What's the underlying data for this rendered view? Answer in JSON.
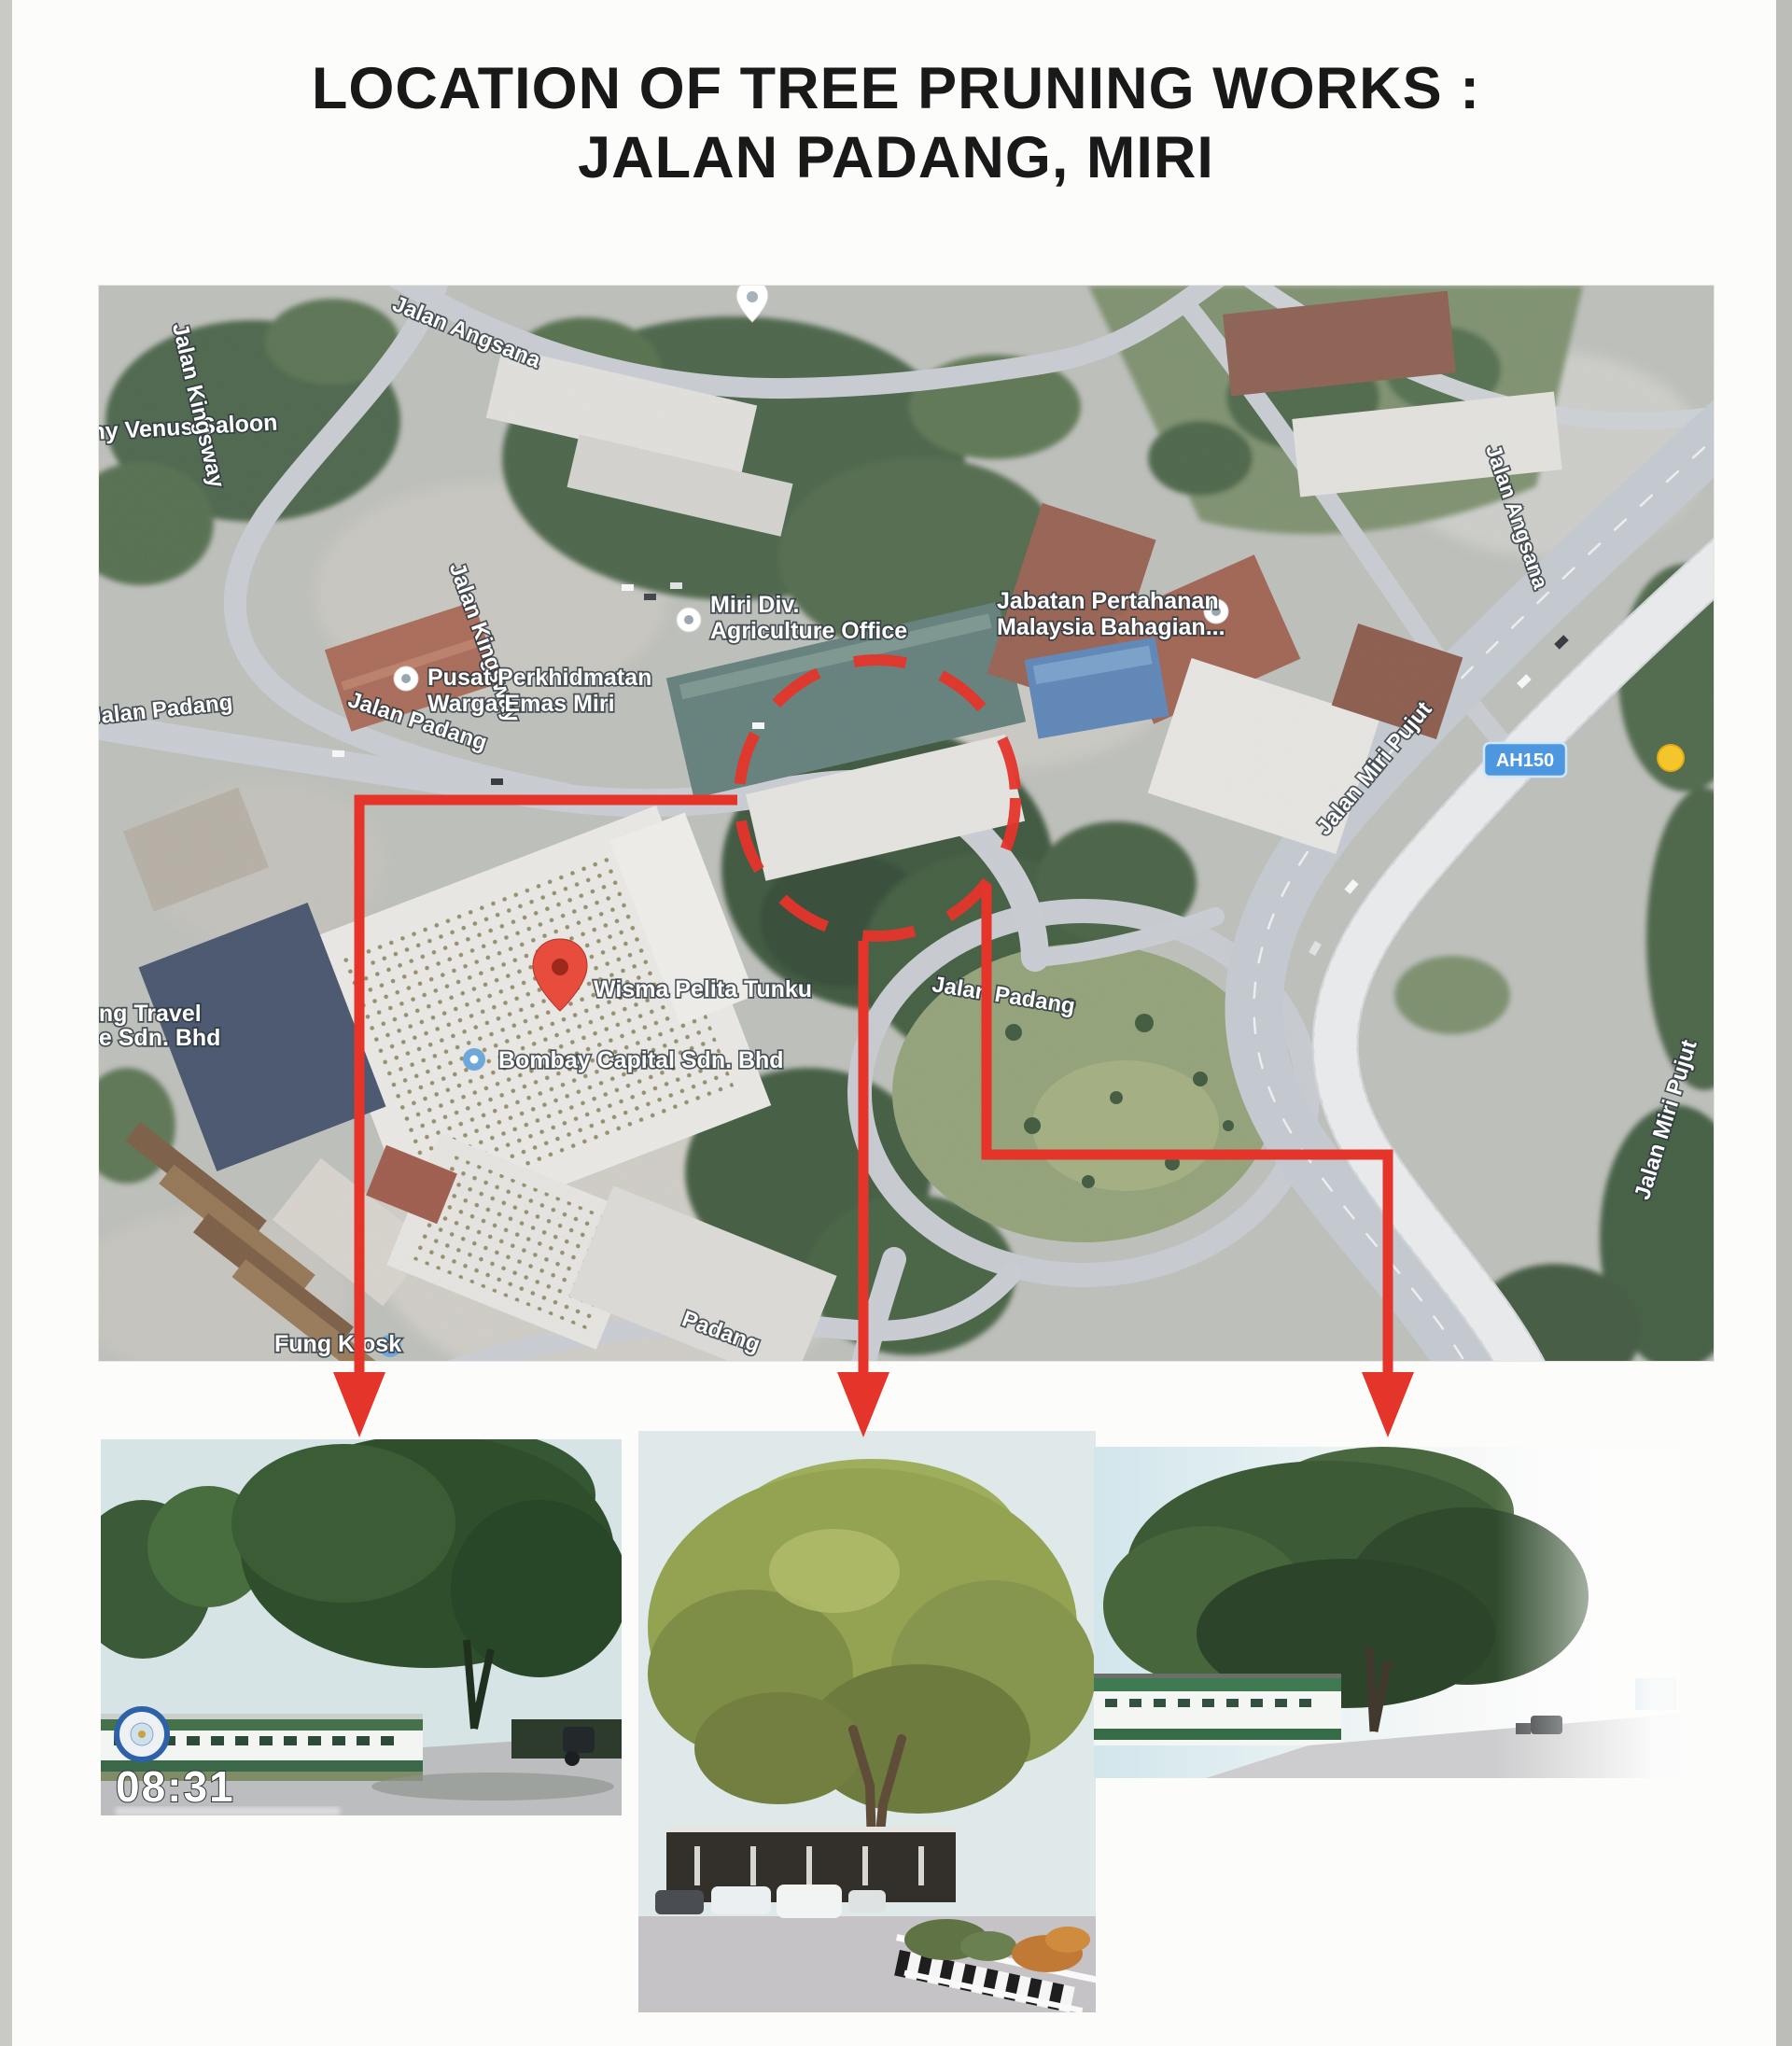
{
  "title": {
    "line1": "LOCATION OF TREE PRUNING WORKS :",
    "line2": "JALAN PADANG, MIRI"
  },
  "map": {
    "road_labels": {
      "angsana_top": "Jalan Angsana",
      "angsana_right": "Jalan Angsana",
      "kingsway_upper": "Jalan Kingsway",
      "kingsway_lower": "Jalan Kingsway",
      "padang_west": "Jalan Padang",
      "padang_mid": "Jalan Padang",
      "padang_center": "Jalan Padang",
      "padang_bottom": "Padang",
      "miri_pujut_upper": "Jalan Miri Pujut",
      "miri_pujut_lower": "Jalan Miri Pujut"
    },
    "place_labels": {
      "venus_saloon": "ny Venus Saloon",
      "pusat_line1": "Pusat Perkhidmatan",
      "pusat_line2": "Warga Emas Miri",
      "miri_div_line1": "Miri Div.",
      "miri_div_line2": "Agriculture Office",
      "jabatan_line1": "Jabatan Pertahanan",
      "jabatan_line2": "Malaysia Bahagian...",
      "travel_line1": "ang Travel",
      "travel_line2": "ce Sdn. Bhd",
      "wisma": "Wisma Pelita Tunku",
      "bombay": "Bombay Capital Sdn. Bhd",
      "fung_kiosk": "Fung Kiosk"
    },
    "route_badge": "AH150"
  },
  "photos": {
    "photo1": {
      "timestamp": "08:31"
    }
  },
  "colors": {
    "annotation_red": "#e5352b",
    "route_badge_blue": "#4d96e0",
    "pin_red": "#e74c3c",
    "marker_blue": "#6fa8d8",
    "marker_yellow": "#f5c62c"
  }
}
